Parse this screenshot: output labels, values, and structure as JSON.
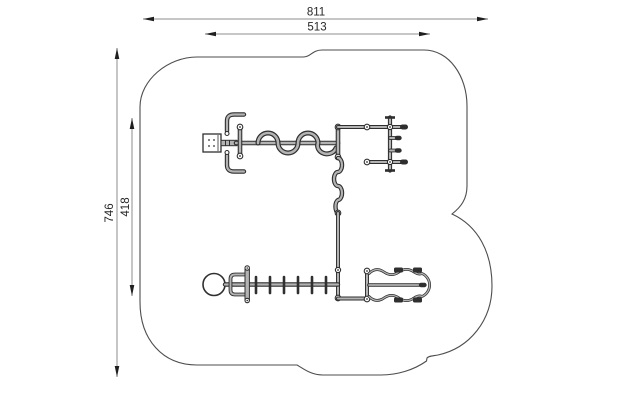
{
  "drawing": {
    "kind": "playground-equipment-plan-view",
    "dimensions": {
      "width_total": "811",
      "width_inner": "513",
      "height_total": "746",
      "height_inner": "418"
    },
    "colors": {
      "background": "#ffffff",
      "line": "#2f2f2f",
      "tube_core": "#b3b3b3",
      "dimension_line": "#8c8c8c",
      "safety_outline": "#4d4d4d"
    },
    "components": {
      "safety_area": "safety-area-outline",
      "panel": "activity-panel",
      "handles": "grab-handles",
      "snake_rail": "snake-overhead-rail",
      "entry_frame": "entry-frame-rungs",
      "snake_pole": "wavy-climbing-pole",
      "main_pole": "main-post-line",
      "monkey_bars": "horizontal-ladder",
      "wheel": "steering-wheel",
      "wobble_bridge": "wobble-bridge"
    }
  }
}
